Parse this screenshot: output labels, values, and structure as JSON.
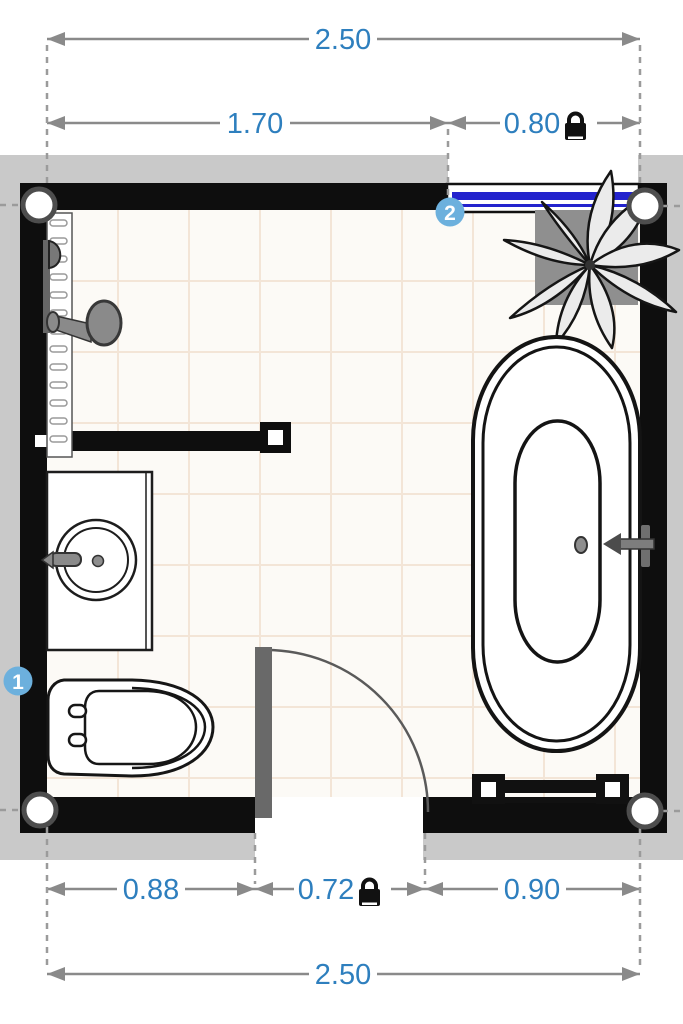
{
  "view": {
    "type": "bathroom-floor-plan",
    "outside_area": "grey-band",
    "floor": "white-tile-grid"
  },
  "dimensions": {
    "top": {
      "total": "2.50",
      "segments": [
        {
          "value": "1.70",
          "locked": false
        },
        {
          "value": "0.80",
          "locked": true
        }
      ]
    },
    "bottom": {
      "total": "2.50",
      "segments": [
        {
          "value": "0.88",
          "locked": false
        },
        {
          "value": "0.72",
          "locked": true
        },
        {
          "value": "0.90",
          "locked": false
        }
      ]
    }
  },
  "markers": [
    {
      "label": "1",
      "position": "left-wall"
    },
    {
      "label": "2",
      "position": "top-wall-window"
    }
  ],
  "fixtures": [
    "shower-with-head",
    "washbasin-vanity",
    "toilet",
    "bathtub-with-faucet",
    "towel-radiator",
    "potted-plant",
    "interior-partition-wall",
    "door-with-swing",
    "window"
  ],
  "icons": {
    "lock": "padlock-locked-icon",
    "corner_handle": "round-wall-corner-handle"
  },
  "colors": {
    "wall": "#0e0e0e",
    "outside_band": "#c9c9c9",
    "floor": "#fcfaf6",
    "tile_line": "#f3e5d7",
    "dimension_text": "#2e7fbe",
    "dimension_line": "#8a8a8a",
    "marker_badge": "#6cb0dd",
    "window_glass": "#2323cd",
    "door_leaf": "#696969",
    "fixture_metal": "#8a8a8a"
  }
}
